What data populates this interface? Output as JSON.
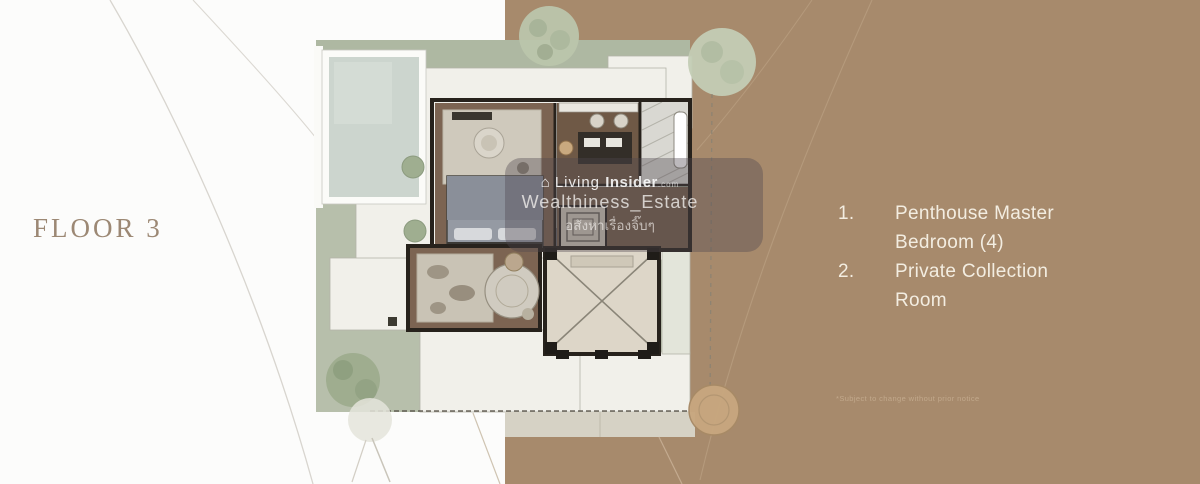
{
  "page": {
    "floor_label": "FLOOR 3",
    "background_left_color": "#fcfcfb",
    "background_right_color": "#a78a6c"
  },
  "legend": {
    "text_color": "#f3ede1",
    "items": [
      {
        "number": "1.",
        "label": "Penthouse Master Bedroom (4)"
      },
      {
        "number": "2.",
        "label": "Private Collection Room"
      }
    ]
  },
  "watermark": {
    "logo_icon": "house-icon",
    "brand_light": "Living",
    "brand_bold": "Insider",
    "brand_suffix": ".com",
    "handle": "Wealthiness_Estate",
    "tagline_thai": "อสังหาเรื่องจิ๊บๆ"
  },
  "disclaimer": "*Subject to change without prior notice",
  "floorplan": {
    "icon_names": [
      "garden-band",
      "swimming-pool",
      "roof-deck",
      "master-bedroom-suite",
      "bed",
      "sitting-rug",
      "walk-in-closet-island",
      "bathroom-marble",
      "bathtub",
      "staircase",
      "private-collection-room",
      "organic-table",
      "void-atrium-x",
      "terrace-planters",
      "trees",
      "driveway-path"
    ]
  }
}
